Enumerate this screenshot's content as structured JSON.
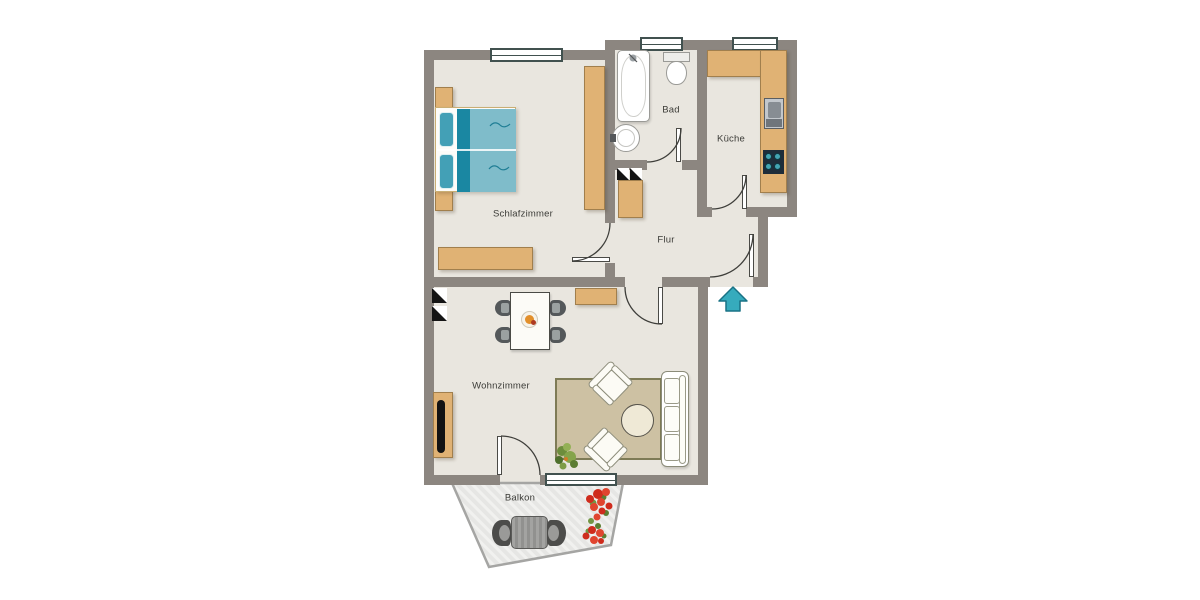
{
  "rooms": {
    "schlafzimmer": {
      "label": "Schlafzimmer"
    },
    "bad": {
      "label": "Bad"
    },
    "kueche": {
      "label": "Küche"
    },
    "flur": {
      "label": "Flur"
    },
    "wohnzimmer": {
      "label": "Wohnzimmer"
    },
    "balkon": {
      "label": "Balkon"
    }
  },
  "symbols": {
    "entrance_arrow": "entrance-direction-arrow",
    "shaft_marker": "installation-shaft-marker",
    "door_swing": "quarter-circle-door-swing"
  },
  "furniture": {
    "schlafzimmer": [
      "double-bed",
      "nightstand",
      "nightstand",
      "wardrobe",
      "dresser"
    ],
    "bad": [
      "bathtub",
      "toilet",
      "washbasin"
    ],
    "kueche": [
      "l-shaped-counter",
      "sink",
      "stove"
    ],
    "flur": [
      "cabinet"
    ],
    "wohnzimmer": [
      "dining-table-with-four-chairs",
      "fruit-bowl",
      "sideboard",
      "tv-board",
      "rug",
      "sofa",
      "armchair",
      "armchair",
      "coffee-table",
      "plant"
    ],
    "balkon": [
      "balcony-table",
      "balcony-chair",
      "balcony-chair",
      "flowers"
    ]
  },
  "colors": {
    "wall": "#8c8680",
    "floor": "#e9e6df",
    "wood": "#e0b274",
    "rug": "#cdc1a3",
    "bed_blanket": "#7fbcca",
    "bed_blanket_dark": "#1a87a2",
    "bed_pillow": "#43a0b6",
    "arrow": "#36abbd",
    "balcony": "#e6e6e4",
    "burner": "#44a5b3"
  }
}
